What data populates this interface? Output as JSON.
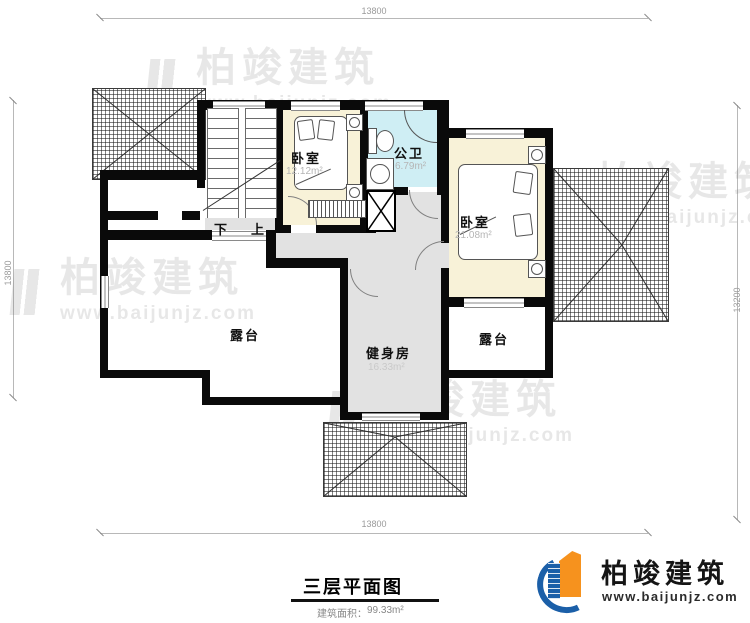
{
  "document": {
    "title": "三层平面图",
    "area_note_label": "建筑面积：",
    "area_note_value": "99.33m²"
  },
  "dimensions": {
    "top": "13800",
    "bottom": "13800",
    "left": "13800",
    "right": "13200"
  },
  "rooms": {
    "bedroom_small": {
      "name": "卧室",
      "area": "12.12m²"
    },
    "bathroom": {
      "name": "公卫",
      "area": "6.79m²"
    },
    "bedroom_master": {
      "name": "卧室",
      "area": "21.08m²"
    },
    "gym": {
      "name": "健身房",
      "area": "16.33m²"
    },
    "terrace_left": {
      "name": "露台"
    },
    "terrace_right": {
      "name": "露台"
    }
  },
  "stairs": {
    "down_label": "下",
    "up_label": "上"
  },
  "watermark": {
    "brand": "柏竣建筑",
    "website": "www.baijunjz.com"
  },
  "logo": {
    "brand": "柏竣建筑",
    "website": "www.baijunjz.com"
  },
  "colors": {
    "wall": "#0a0a0a",
    "bedroom_fill": "#f8f2d8",
    "bathroom_fill": "#cfeef4",
    "hall_fill": "#e2e2e2",
    "dimension_text": "#9a9a9a"
  }
}
